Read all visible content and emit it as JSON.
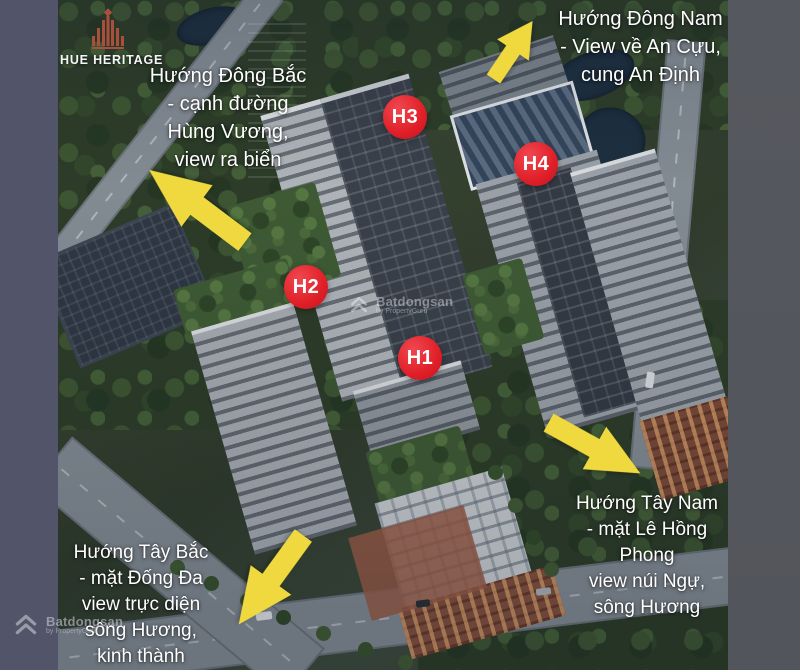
{
  "project": {
    "logo_title": "HUE HERITAGE"
  },
  "direction_labels": {
    "dong_bac": {
      "position": "top-left",
      "lines": [
        "Hướng Đông Bắc",
        "- cạnh đường",
        "Hùng Vương,",
        "view ra biển"
      ]
    },
    "dong_nam": {
      "position": "top-right",
      "lines": [
        "Hướng Đông Nam",
        "- View về An Cựu,",
        "cung An Định"
      ]
    },
    "tay_bac": {
      "position": "bottom-left",
      "lines": [
        "Hướng Tây Bắc",
        "- mặt Đống Đa",
        "view trực diện",
        "sông Hương,",
        "kinh thành"
      ]
    },
    "tay_nam": {
      "position": "bottom-right",
      "lines": [
        "Hướng Tây Nam",
        "- mặt Lê Hồng",
        "Phong",
        "view núi Ngự,",
        "sông Hương"
      ]
    }
  },
  "tower_badges": [
    {
      "label": "H1"
    },
    {
      "label": "H2"
    },
    {
      "label": "H3"
    },
    {
      "label": "H4"
    }
  ],
  "arrows": [
    {
      "screen_direction": "up-left",
      "refers_to": "Hướng Đông Bắc"
    },
    {
      "screen_direction": "up-right",
      "refers_to": "Hướng Đông Nam"
    },
    {
      "screen_direction": "down-left",
      "refers_to": "Hướng Tây Bắc"
    },
    {
      "screen_direction": "down-right",
      "refers_to": "Hướng Tây Nam"
    }
  ],
  "watermark": {
    "brand": "Batdongsan",
    "byline": "by PropertyGuru"
  },
  "colors": {
    "arrow_yellow": "#f0d93f",
    "badge_red": "#e8242c",
    "label_text": "#ffffff",
    "left_band": "#525469",
    "right_band": "#55575f",
    "logo_emblem": "#a8503c"
  }
}
